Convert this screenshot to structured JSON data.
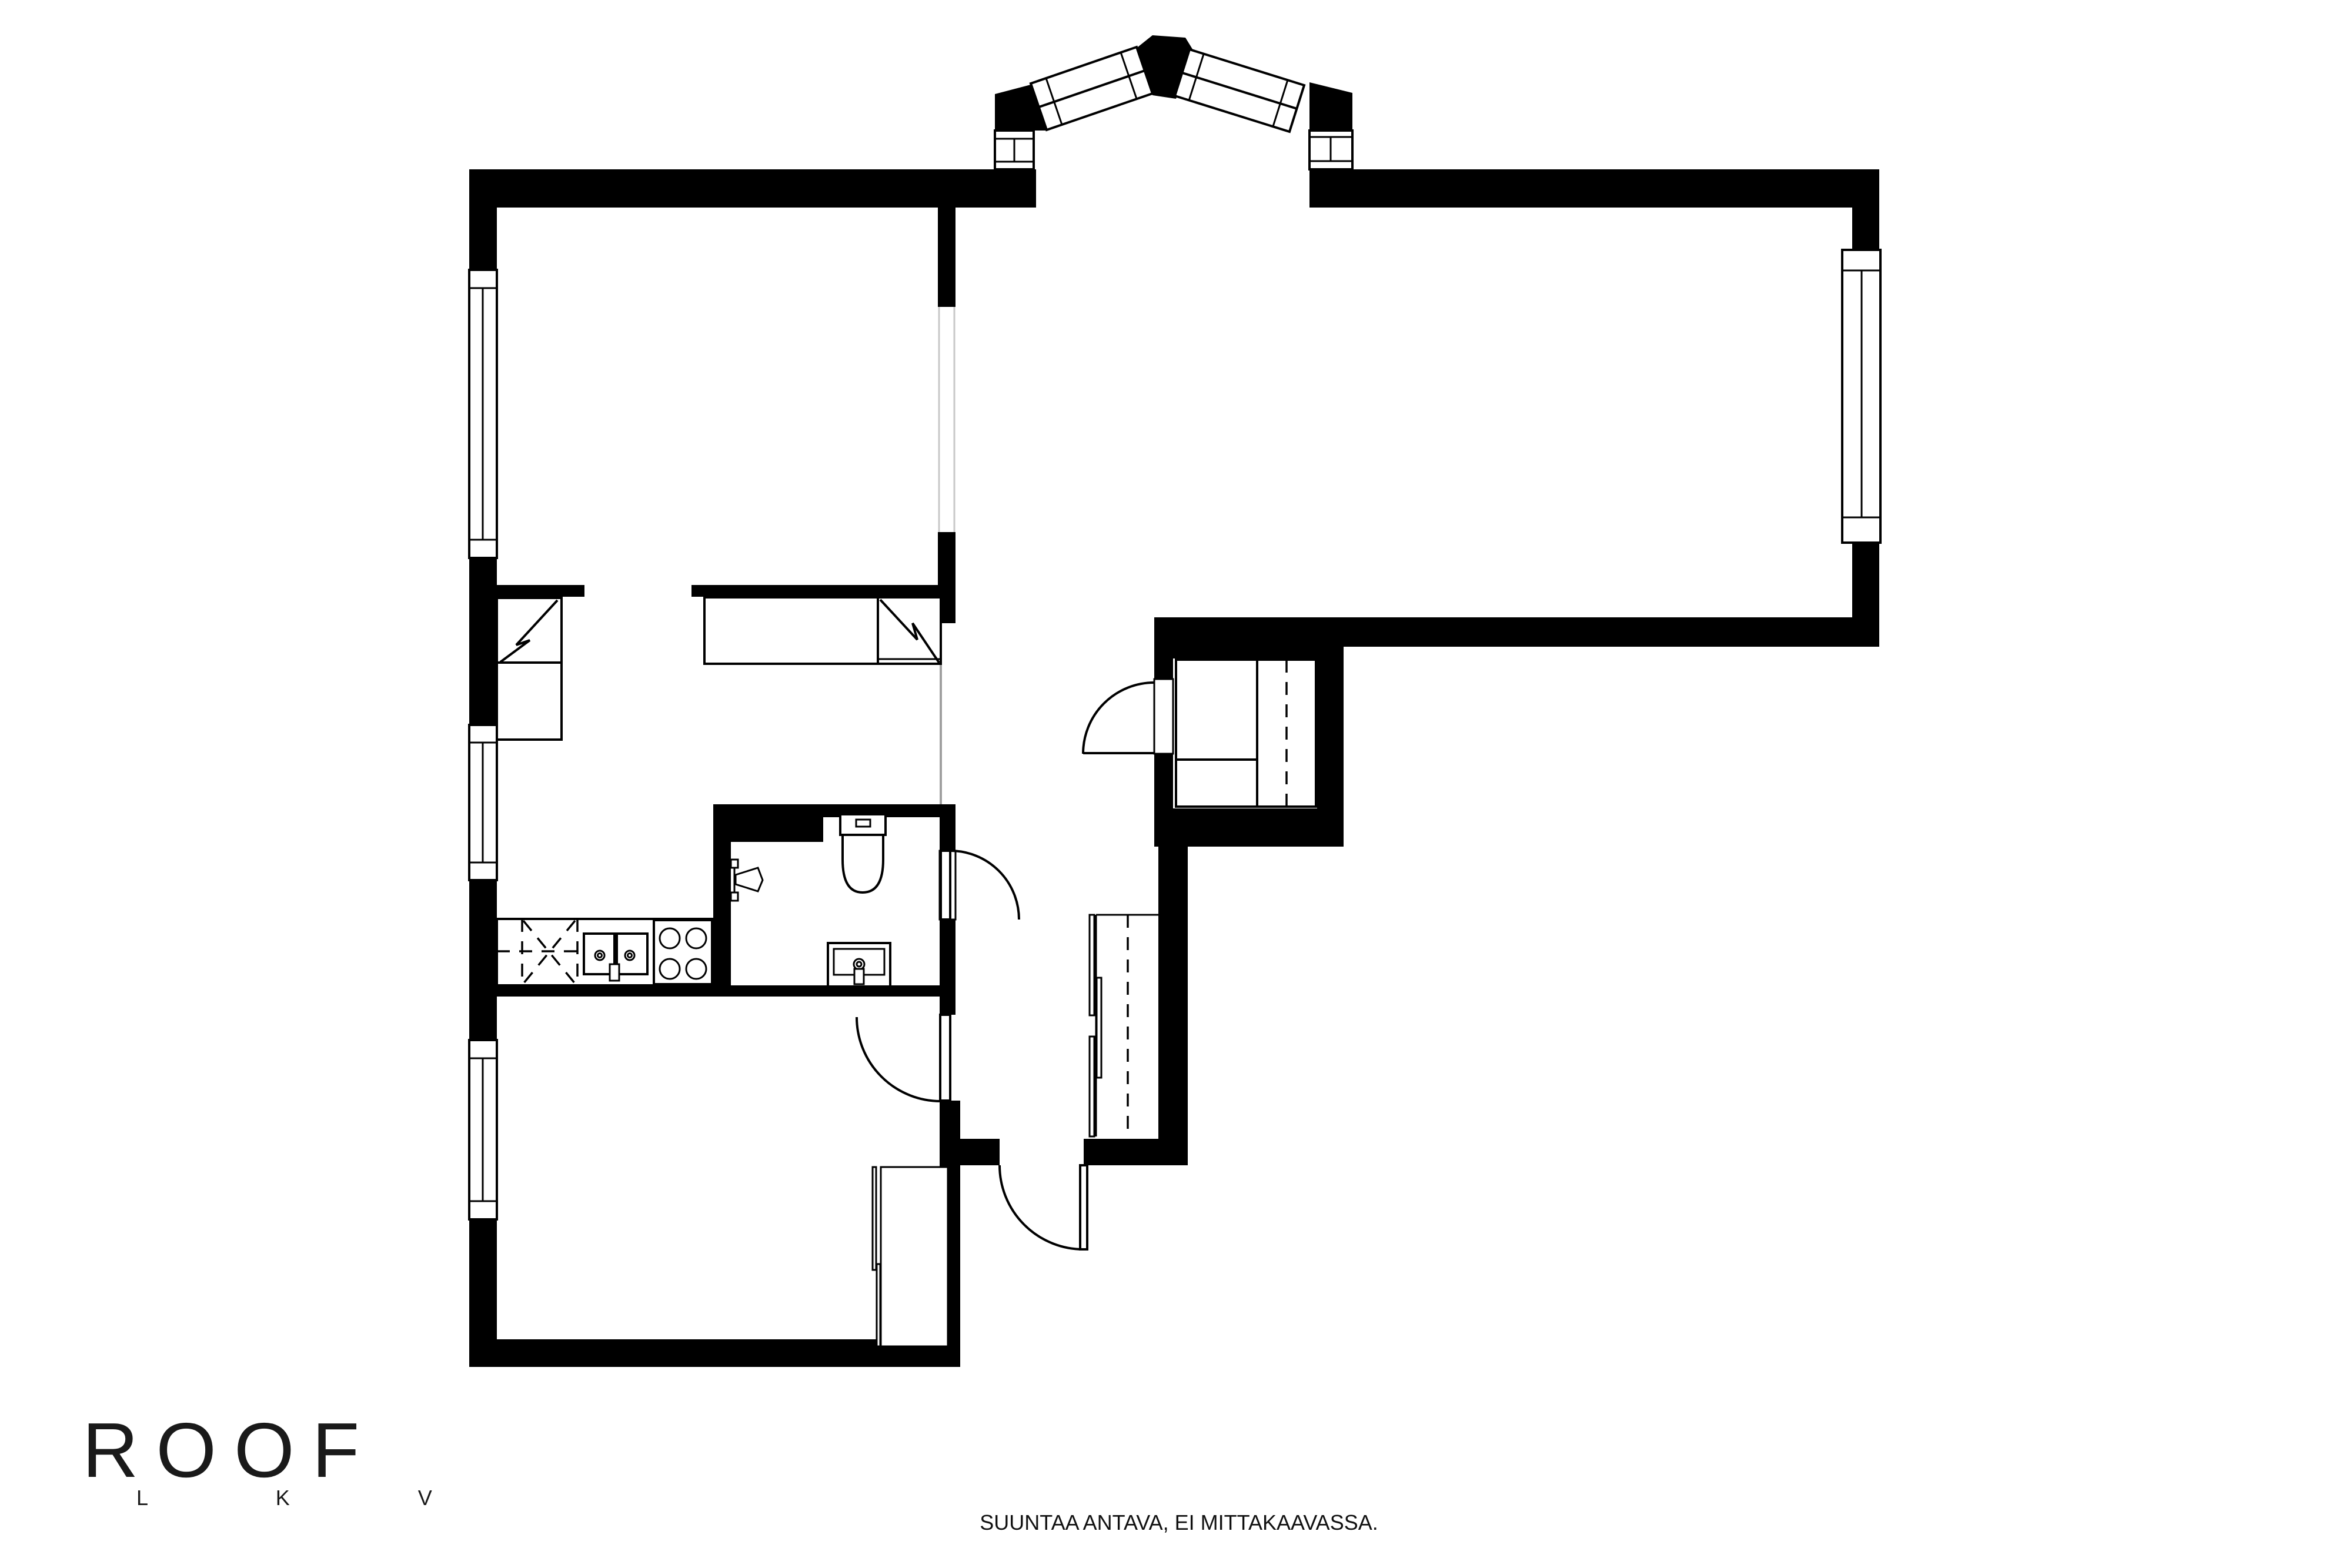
{
  "logo": {
    "brand": "ROOF",
    "sub": "L K V"
  },
  "footer": {
    "disclaimer": "SUUNTAA ANTAVA, EI MITTAKAAVASSA."
  },
  "palette": {
    "wall": "#000000",
    "background": "#ffffff",
    "open_passage_line": "#a0a0a0"
  },
  "fixtures": {
    "bay_window": "peaked-bay-window",
    "windows": [
      "window-west-top-room",
      "window-west-kitchen",
      "window-west-bottom-room",
      "window-east-living-room"
    ],
    "doors": [
      "walk-in-closet-door",
      "bathroom-door",
      "bottom-room-door",
      "entrance-door"
    ],
    "kitchen": [
      "kitchen-counter",
      "appliance-reservation-dashed",
      "double-sink",
      "stove-4-burner"
    ],
    "bathroom": [
      "toilet",
      "washbasin",
      "shower"
    ],
    "storage": [
      "wardrobe-with-zigzag-left",
      "wardrobe-with-zigzag-right",
      "walk-in-closet-unit",
      "sliding-door-closet-hall",
      "wardrobe-bottom-room"
    ]
  }
}
